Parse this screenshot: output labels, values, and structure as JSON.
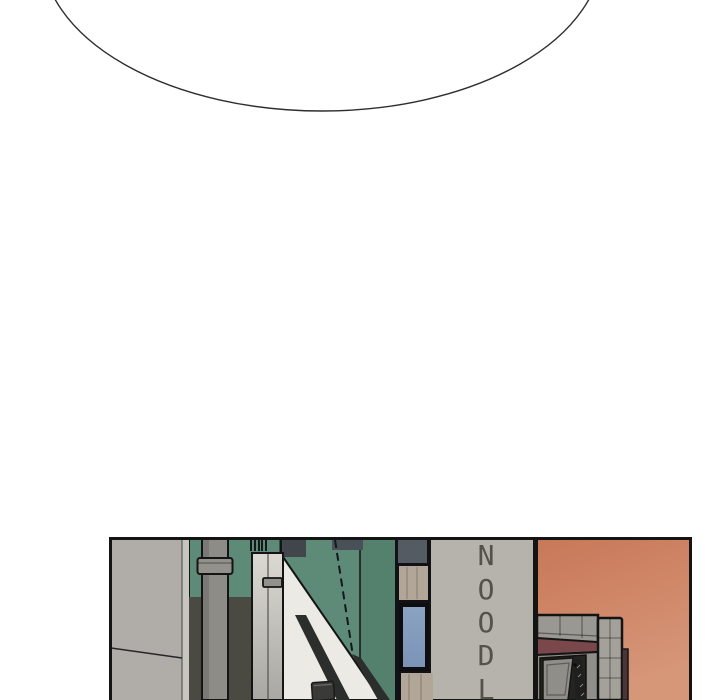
{
  "sign": {
    "letters": [
      "N",
      "O",
      "O",
      "D",
      "L"
    ]
  },
  "colors": {
    "page_background": "#ffffff",
    "bubble_fill": "#ffffff",
    "bubble_stroke": "#2e2e2e",
    "panel_border": "#141414",
    "sky_top": "#c87858",
    "sky_bottom": "#d69678",
    "green_wall": "#5d8b78",
    "green_wall_dark": "#54806e",
    "olive_wall": "#4a4a43",
    "left_wall": "#b0ada8",
    "left_wall_strip": "#c7c5bf",
    "pipe": "#8d8c87",
    "pipe_coupling": "#92918c",
    "pillar_top": "#dbd9d2",
    "pillar_bottom": "#a9a7a2",
    "white_band": "#eceae4",
    "rail_dark": "#2c2e2b",
    "bin_dark": "#3a3a38",
    "slate_roof_a": "#41464d",
    "slate_roof_b": "#4a5057",
    "slate_panel": "#555b63",
    "tan_panel": "#b2a698",
    "window_glass_top": "#8ba3c2",
    "window_glass_bottom": "#7b94b6",
    "sign_wall": "#b6b3ad",
    "sign_text": "#55524a",
    "structure_gray": "#9a9893",
    "structure_column": "#a3a19a",
    "beam_maroon": "#7a484a",
    "side_strip_maroon": "#4b3536",
    "door_face": "#8f8e89",
    "door_dark": "#242421",
    "door_edge_dark": "#1f1f1d"
  }
}
